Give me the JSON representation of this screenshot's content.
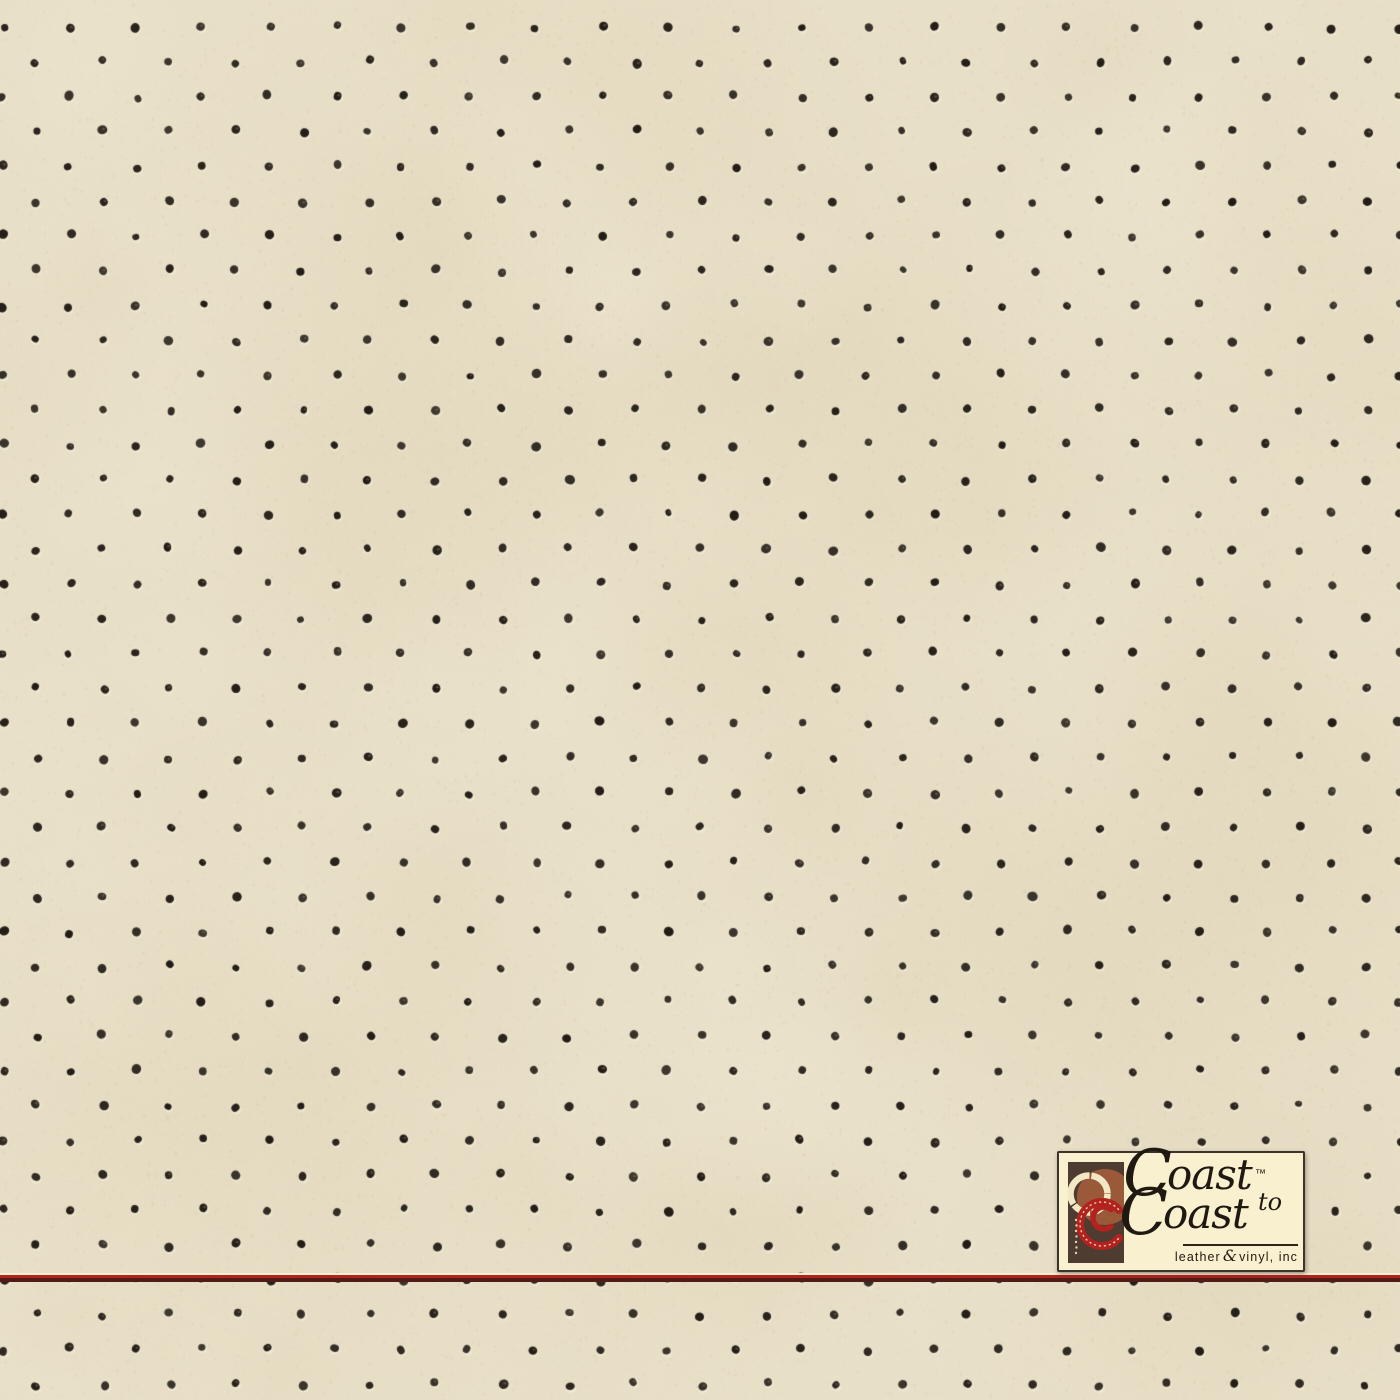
{
  "texture": {
    "width": 1400,
    "height": 1400,
    "base_color": "#e8dfc7",
    "grain_light": "#f8f3e2",
    "grain_dark": "#a3946e",
    "mottle_light": "#f4eedb",
    "mottle_dark": "#d3c6a2",
    "perforation": {
      "color": "#221c15",
      "inner_highlight": "#8a7a5f",
      "emboss_light": "#f6f0dd",
      "col_spacing": 66.5,
      "row_spacing": 34.8,
      "even_row_start_x": 3,
      "odd_row_start_x": 36.5,
      "start_y": 27,
      "radius": 4.1,
      "jitter": 2.2
    }
  },
  "divider": {
    "top": 1273,
    "layers": [
      {
        "name": "divider-highlight-line",
        "color": "#f6eed2",
        "height": 2
      },
      {
        "name": "divider-red-line",
        "color": "#b3231e",
        "height": 3
      },
      {
        "name": "divider-maroon-line",
        "color": "#511c15",
        "height": 4
      }
    ]
  },
  "logo": {
    "background": "#f9f0cf",
    "border_color": "#3b342a",
    "text_color": "#1f1912",
    "rule_color": "#2a241b",
    "word_top_cap": "C",
    "word_top_rest": "oast",
    "trademark": "™",
    "word_to": "to",
    "word_bottom_cap": "C",
    "word_bottom_rest": "oast",
    "tagline_left": "leather",
    "tagline_amp": "&",
    "tagline_right": "vinyl, inc",
    "mark_colors": {
      "square": "#4d3c2f",
      "brush_ring": "#f3e8c4",
      "sienna_circle": "#9a5a3a",
      "red_ring": "#b2221f",
      "stitch": "#f0e4bf"
    }
  }
}
